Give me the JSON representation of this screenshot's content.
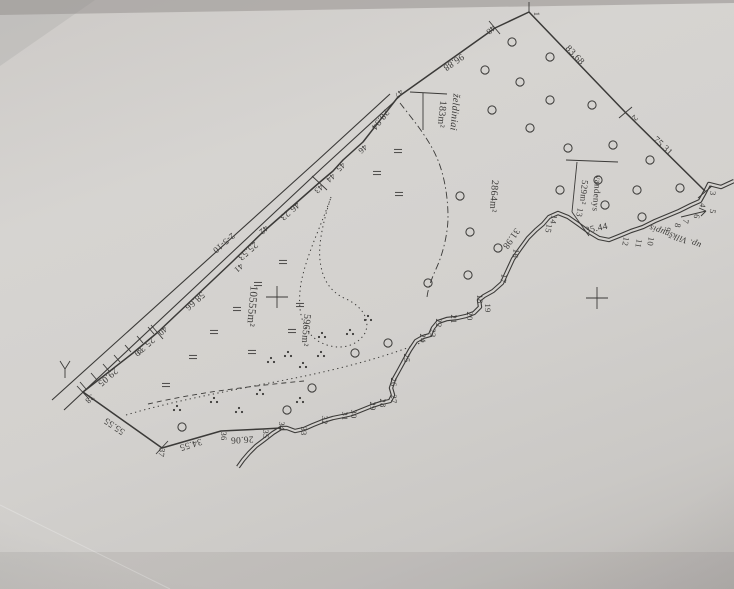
{
  "document": {
    "kind": "scanned land survey plan (photograph of paper)",
    "river_label": "up. Vilkšnupis",
    "road_label": "2-5-10"
  },
  "map": {
    "colors": {
      "paper": "#d3d1ce",
      "ink": "#3b3a38",
      "faint": "#6b6966"
    },
    "area_labels": [
      {
        "t": "želdiniai",
        "x": 452,
        "y": 112,
        "r": 95,
        "s": 10,
        "i": 1
      },
      {
        "t": "183m²",
        "x": 439,
        "y": 114,
        "r": 95,
        "s": 10,
        "i": 0
      },
      {
        "t": "2864m²",
        "x": 491,
        "y": 196,
        "r": 94,
        "s": 10,
        "i": 0
      },
      {
        "t": "vandenys",
        "x": 594,
        "y": 193,
        "r": 95,
        "s": 9,
        "i": 0
      },
      {
        "t": "529m²",
        "x": 581,
        "y": 192,
        "r": 95,
        "s": 9,
        "i": 0
      },
      {
        "t": "10555m²",
        "x": 249,
        "y": 306,
        "r": 95,
        "s": 11,
        "i": 0
      },
      {
        "t": "5965m²",
        "x": 303,
        "y": 330,
        "r": 95,
        "s": 10,
        "i": 0
      },
      {
        "t": "up. Vilkšnupis",
        "x": 676,
        "y": 234,
        "r": 200,
        "s": 9,
        "i": 1
      },
      {
        "t": "2-5-10",
        "x": 222,
        "y": 241,
        "r": 139,
        "s": 9,
        "i": 0
      }
    ],
    "distance_labels": [
      {
        "t": "96.88",
        "x": 452,
        "y": 60,
        "r": 145
      },
      {
        "t": "83.68",
        "x": 573,
        "y": 57,
        "r": 46
      },
      {
        "t": "75.31",
        "x": 661,
        "y": 148,
        "r": 44
      },
      {
        "t": "35.44",
        "x": 597,
        "y": 231,
        "r": -12
      },
      {
        "t": "31.98",
        "x": 509,
        "y": 237,
        "r": 125
      },
      {
        "t": "28.94",
        "x": 378,
        "y": 118,
        "r": 128
      },
      {
        "t": "46.23",
        "x": 288,
        "y": 209,
        "r": 139
      },
      {
        "t": "25.53",
        "x": 246,
        "y": 249,
        "r": 139
      },
      {
        "t": "58.66",
        "x": 193,
        "y": 299,
        "r": 139
      },
      {
        "t": "25.31",
        "x": 143,
        "y": 344,
        "r": 139
      },
      {
        "t": "29.05",
        "x": 106,
        "y": 375,
        "r": 139
      },
      {
        "t": "55.55",
        "x": 116,
        "y": 424,
        "r": 215
      },
      {
        "t": "34.55",
        "x": 190,
        "y": 442,
        "r": 163
      },
      {
        "t": "26.06",
        "x": 242,
        "y": 437,
        "r": 177
      }
    ],
    "point_labels": [
      {
        "t": "1",
        "x": 534,
        "y": 14,
        "r": 90
      },
      {
        "t": "2",
        "x": 633,
        "y": 116,
        "r": 135
      },
      {
        "t": "3",
        "x": 710,
        "y": 193,
        "r": 95
      },
      {
        "t": "4",
        "x": 700,
        "y": 205,
        "r": 100
      },
      {
        "t": "5",
        "x": 710,
        "y": 211,
        "r": 100
      },
      {
        "t": "6",
        "x": 694,
        "y": 216,
        "r": 100
      },
      {
        "t": "7",
        "x": 683,
        "y": 221,
        "r": 100
      },
      {
        "t": "8",
        "x": 675,
        "y": 225,
        "r": 100
      },
      {
        "t": "9",
        "x": 665,
        "y": 229,
        "r": 100
      },
      {
        "t": "10",
        "x": 648,
        "y": 241,
        "r": 100
      },
      {
        "t": "11",
        "x": 636,
        "y": 243,
        "r": 100
      },
      {
        "t": "12",
        "x": 623,
        "y": 241,
        "r": 100
      },
      {
        "t": "13",
        "x": 577,
        "y": 212,
        "r": 100
      },
      {
        "t": "14",
        "x": 551,
        "y": 219,
        "r": 100
      },
      {
        "t": "15",
        "x": 546,
        "y": 228,
        "r": 100
      },
      {
        "t": "16",
        "x": 513,
        "y": 253,
        "r": 100
      },
      {
        "t": "17",
        "x": 501,
        "y": 278,
        "r": 100
      },
      {
        "t": "18",
        "x": 477,
        "y": 299,
        "r": 90
      },
      {
        "t": "19",
        "x": 485,
        "y": 308,
        "r": 90
      },
      {
        "t": "20",
        "x": 467,
        "y": 316,
        "r": 90
      },
      {
        "t": "21",
        "x": 451,
        "y": 319,
        "r": 90
      },
      {
        "t": "22",
        "x": 436,
        "y": 323,
        "r": 90
      },
      {
        "t": "23",
        "x": 430,
        "y": 333,
        "r": 90
      },
      {
        "t": "24",
        "x": 420,
        "y": 338,
        "r": 90
      },
      {
        "t": "25",
        "x": 404,
        "y": 358,
        "r": 90
      },
      {
        "t": "26",
        "x": 391,
        "y": 382,
        "r": 90
      },
      {
        "t": "27",
        "x": 391,
        "y": 399,
        "r": 90
      },
      {
        "t": "28",
        "x": 380,
        "y": 403,
        "r": 90
      },
      {
        "t": "29",
        "x": 370,
        "y": 406,
        "r": 90
      },
      {
        "t": "30",
        "x": 351,
        "y": 414,
        "r": 90
      },
      {
        "t": "31",
        "x": 342,
        "y": 416,
        "r": 90
      },
      {
        "t": "32",
        "x": 322,
        "y": 420,
        "r": 90
      },
      {
        "t": "33",
        "x": 301,
        "y": 431,
        "r": 90
      },
      {
        "t": "34",
        "x": 279,
        "y": 426,
        "r": 90
      },
      {
        "t": "35",
        "x": 263,
        "y": 434,
        "r": 90
      },
      {
        "t": "36",
        "x": 221,
        "y": 436,
        "r": 90
      },
      {
        "t": "37",
        "x": 159,
        "y": 452,
        "r": 100
      },
      {
        "t": "38",
        "x": 88,
        "y": 397,
        "r": 139
      },
      {
        "t": "39",
        "x": 137,
        "y": 350,
        "r": 139
      },
      {
        "t": "40",
        "x": 161,
        "y": 329,
        "r": 139
      },
      {
        "t": "41",
        "x": 237,
        "y": 266,
        "r": 139
      },
      {
        "t": "42",
        "x": 262,
        "y": 228,
        "r": 139
      },
      {
        "t": "43",
        "x": 317,
        "y": 187,
        "r": 139
      },
      {
        "t": "44",
        "x": 329,
        "y": 176,
        "r": 139
      },
      {
        "t": "45",
        "x": 339,
        "y": 165,
        "r": 139
      },
      {
        "t": "46",
        "x": 361,
        "y": 147,
        "r": 139
      },
      {
        "t": "47",
        "x": 397,
        "y": 92,
        "r": 139
      },
      {
        "t": "48",
        "x": 489,
        "y": 28,
        "r": 139
      }
    ],
    "paths": {
      "boundary": "M281,428 L263,429 L221,431 L162,448 L83,392 L133,353 L158,332 L232,262 L263,232 L320,182 L333,171 L343,160 L363,142 L398,97 L495,28 L529,12 L625,112 L705,191",
      "stream": "M734,181 L721,187 L709,184 L705,192 L700,201 L691,205 L679,211 L667,216 L655,221 L643,227 L631,231 L619,236 L609,240 L599,238 L589,232 L578,224 L568,217 L558,213 L549,217 L543,224 L536,230 L528,238 L520,249 L513,259 L507,272 L502,283 L493,291 L484,296 L479,300 L480,307 L474,313 L466,316 L457,318 L447,319 L438,322 L433,328 L430,335 L423,337 L416,341 L410,350 L405,359 L399,370 L394,379 L391,388 L393,395 L390,401 L381,403 L372,406 L362,410 L352,414 L343,416 L333,418 L323,421 L313,425 L304,429 L295,431 L287,428 L281,428 L273,433 L264,440 L256,446 L249,453 L243,460 L238,467",
      "roads": [
        "M52,400 L318,160 L390,94",
        "M64,410 L322,168 L394,102"
      ],
      "dotted": [
        "M331,197 C322,224 307,253 301,283 C297,309 301,329 318,341 C337,352 357,347 365,333 C371,320 362,306 346,299 C330,292 322,279 320,260 C318,243 324,219 331,197",
        "M126,415 C180,399 240,389 300,377 C344,368 392,355 425,341"
      ],
      "dashed": [
        "M148,404 C200,392 252,386 304,381"
      ],
      "dashdot": [
        "M400,103 C414,121 431,141 439,163 C445,179 448,199 448,217 C448,233 443,254 436,269 C431,280 428,289 427,297"
      ]
    },
    "segments": [
      [
        529,
        2,
        529,
        12
      ],
      [
        489,
        21,
        500,
        34
      ],
      [
        619,
        118,
        632,
        107
      ],
      [
        698,
        198,
        712,
        186
      ],
      [
        77,
        386,
        89,
        399
      ],
      [
        156,
        454,
        168,
        441
      ],
      [
        151,
        325,
        163,
        339
      ],
      [
        312,
        176,
        327,
        190
      ],
      [
        410,
        92,
        447,
        94
      ],
      [
        423,
        93,
        423,
        130
      ],
      [
        566,
        160,
        618,
        162
      ],
      [
        577,
        162,
        572,
        212
      ],
      [
        572,
        212,
        589,
        236
      ],
      [
        681,
        217,
        706,
        211
      ],
      [
        706,
        211,
        699,
        208
      ],
      [
        706,
        211,
        701,
        216
      ],
      [
        65,
        378,
        65,
        369
      ],
      [
        65,
        369,
        60,
        361
      ],
      [
        65,
        369,
        70,
        361
      ],
      [
        266,
        297,
        288,
        297
      ],
      [
        277,
        286,
        277,
        308
      ],
      [
        586,
        298,
        608,
        298
      ],
      [
        597,
        287,
        597,
        309
      ],
      [
        86,
        389,
        80,
        382
      ],
      [
        97,
        380,
        91,
        373
      ],
      [
        109,
        371,
        103,
        364
      ],
      [
        120,
        362,
        114,
        355
      ],
      [
        131,
        352,
        125,
        345
      ],
      [
        143,
        343,
        137,
        336
      ],
      [
        154,
        334,
        148,
        327
      ]
    ],
    "orchard_circles": [
      [
        512,
        42
      ],
      [
        550,
        57
      ],
      [
        485,
        70
      ],
      [
        520,
        82
      ],
      [
        550,
        100
      ],
      [
        592,
        105
      ],
      [
        492,
        110
      ],
      [
        530,
        128
      ],
      [
        568,
        148
      ],
      [
        613,
        145
      ],
      [
        650,
        160
      ],
      [
        680,
        188
      ],
      [
        598,
        180
      ],
      [
        560,
        190
      ],
      [
        637,
        190
      ],
      [
        605,
        205
      ],
      [
        642,
        217
      ],
      [
        498,
        248
      ],
      [
        460,
        196
      ],
      [
        470,
        232
      ],
      [
        468,
        275
      ],
      [
        428,
        283
      ],
      [
        388,
        343
      ],
      [
        355,
        353
      ],
      [
        312,
        388
      ],
      [
        287,
        410
      ],
      [
        182,
        427
      ]
    ],
    "meadow_marks": [
      [
        283,
        262
      ],
      [
        258,
        284
      ],
      [
        237,
        309
      ],
      [
        214,
        332
      ],
      [
        193,
        357
      ],
      [
        166,
        385
      ],
      [
        252,
        352
      ],
      [
        292,
        331
      ],
      [
        300,
        305
      ],
      [
        398,
        151
      ],
      [
        377,
        173
      ],
      [
        399,
        194
      ]
    ],
    "shrub_clusters": [
      [
        322,
        333
      ],
      [
        288,
        352
      ],
      [
        271,
        358
      ],
      [
        303,
        363
      ],
      [
        321,
        352
      ],
      [
        350,
        330
      ],
      [
        177,
        406
      ],
      [
        214,
        398
      ],
      [
        239,
        408
      ],
      [
        368,
        316
      ],
      [
        260,
        390
      ],
      [
        300,
        398
      ]
    ]
  }
}
